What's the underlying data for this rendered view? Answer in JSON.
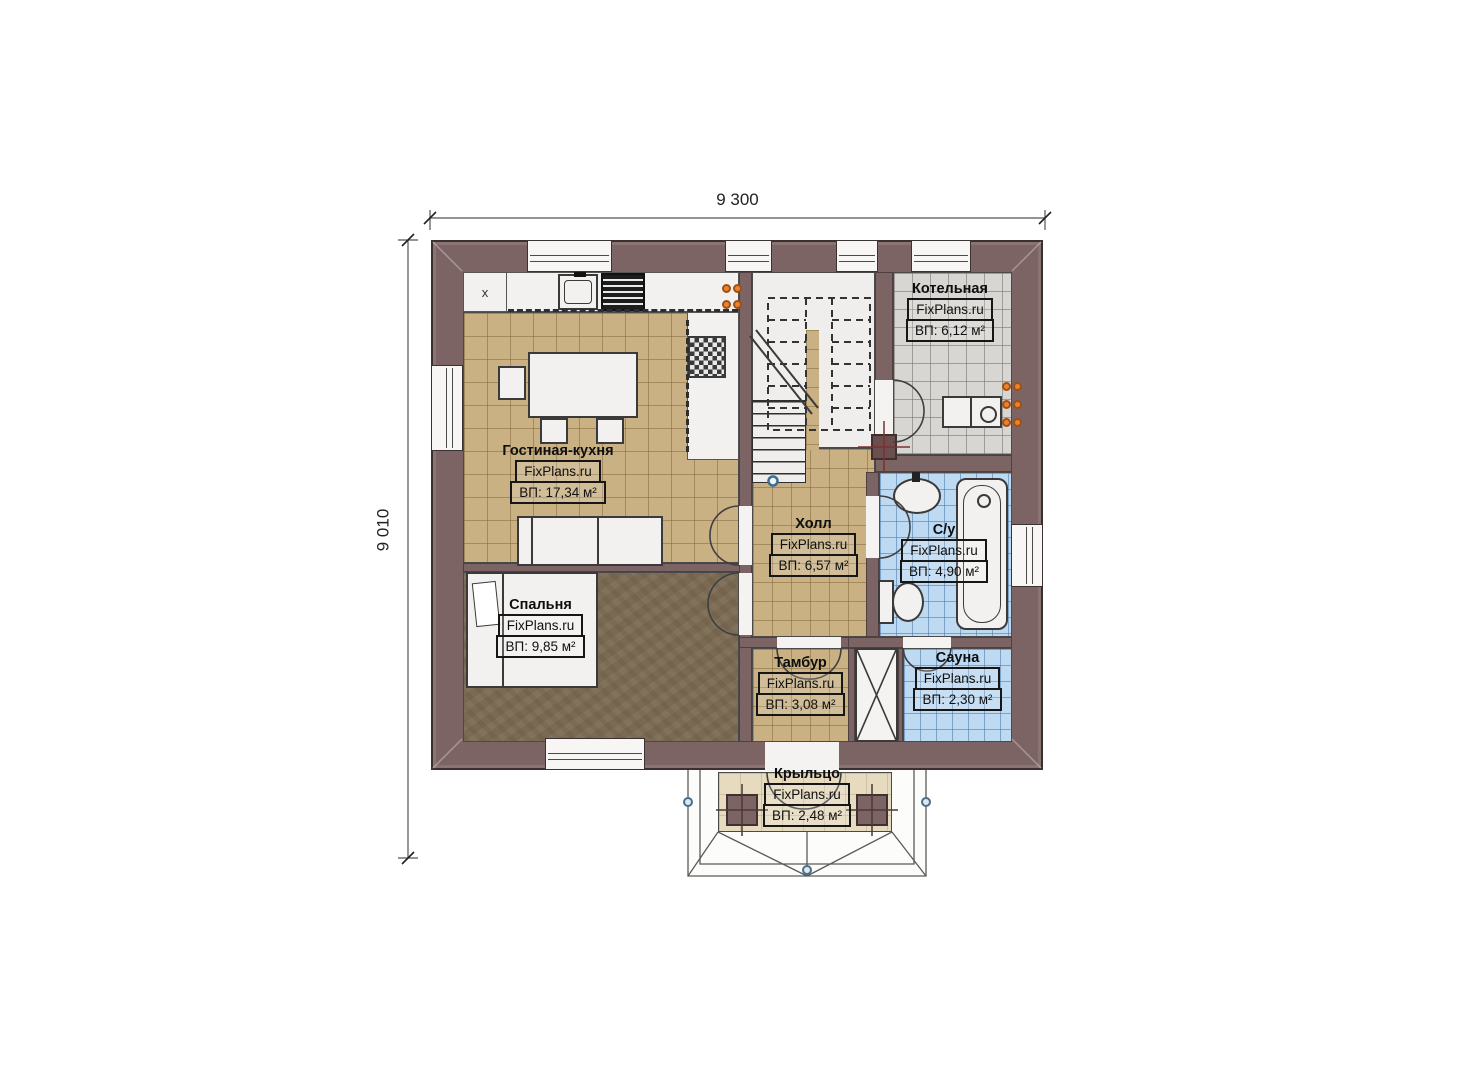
{
  "plan_title": "First floor plan",
  "dimensions": {
    "width_label": "9 300",
    "height_label": "9 010"
  },
  "rooms": [
    {
      "id": "boiler",
      "name": "Котельная",
      "brand": "FixPlans.ru",
      "area": "ВП: 6,12 м²"
    },
    {
      "id": "living",
      "name": "Гостиная-кухня",
      "brand": "FixPlans.ru",
      "area": "ВП: 17,34 м²"
    },
    {
      "id": "hall",
      "name": "Холл",
      "brand": "FixPlans.ru",
      "area": "ВП: 6,57 м²"
    },
    {
      "id": "bathroom",
      "name": "С/у",
      "brand": "FixPlans.ru",
      "area": "ВП: 4,90 м²"
    },
    {
      "id": "bedroom",
      "name": "Спальня",
      "brand": "FixPlans.ru",
      "area": "ВП: 9,85 м²"
    },
    {
      "id": "tambour",
      "name": "Тамбур",
      "brand": "FixPlans.ru",
      "area": "ВП: 3,08 м²"
    },
    {
      "id": "sauna",
      "name": "Сауна",
      "brand": "FixPlans.ru",
      "area": "ВП: 2,30 м²"
    },
    {
      "id": "porch",
      "name": "Крыльцо",
      "brand": "FixPlans.ru",
      "area": "ВП: 2,48 м²"
    }
  ],
  "symbols": {
    "cabinet_mark": "x"
  },
  "colors": {
    "wall": "#7C6464",
    "tile_tan": "#C9B183",
    "tile_gray": "#D8D6D2",
    "tile_blue": "#BEDAF2",
    "bedroom_floor": "#7B6A52",
    "porch_floor": "#E6DABF",
    "radiator": "#F08030",
    "outline": "#3B3030"
  }
}
